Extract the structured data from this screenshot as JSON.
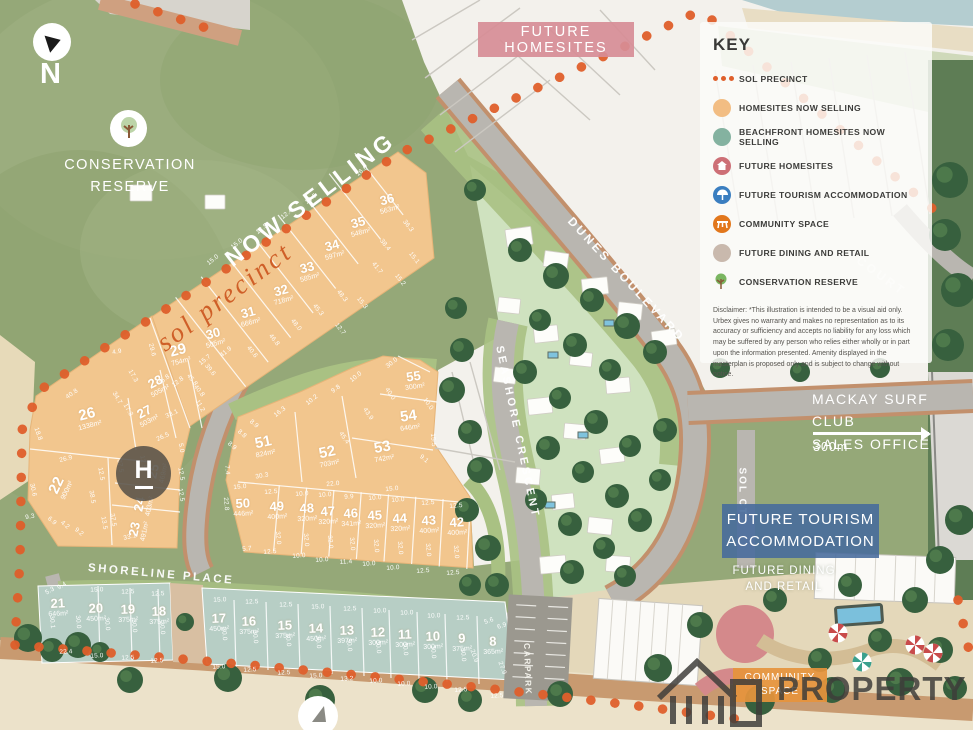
{
  "labels": {
    "north": "N",
    "conservation_line1": "CONSERVATION",
    "conservation_line2": "RESERVE",
    "future_homesites": "FUTURE HOMESITES",
    "now_selling": "NOW SELLING",
    "sol_precinct_script": "sol precinct",
    "helipad": "H",
    "surf_line1": "MACKAY SURF CLUB",
    "surf_line2": "SALES OFFICE",
    "surf_distance": "300m",
    "tourism_line1": "FUTURE TOURISM",
    "tourism_line2": "ACCOMMODATION",
    "dining_line1": "FUTURE DINING",
    "dining_line2": "AND RETAIL",
    "community_line1": "COMMUNITY",
    "community_line2": "SPACE",
    "watermark": "PROPERTY"
  },
  "streets": {
    "dunes": "DUNES BOULEVARD",
    "seashore": "SEASHORE CRESCENT",
    "shoreline": "SHORELINE PLACE",
    "sol": "SOL CT",
    "court": "COURT",
    "carpark": "CARPARK"
  },
  "key": {
    "title": "KEY",
    "items": [
      {
        "label": "SOL PRECINCT",
        "icon": "dots",
        "color": "#df5f2b"
      },
      {
        "label": "HOMESITES NOW SELLING",
        "icon": "circle",
        "color": "#f2bd83"
      },
      {
        "label": "BEACHFRONT HOMESITES NOW SELLING",
        "icon": "circle",
        "color": "#84b2a0"
      },
      {
        "label": "FUTURE HOMESITES",
        "icon": "house",
        "color": "#cd6f76"
      },
      {
        "label": "FUTURE TOURISM ACCOMMODATION",
        "icon": "tourism",
        "color": "#3a7ec0"
      },
      {
        "label": "COMMUNITY SPACE",
        "icon": "community",
        "color": "#e2771c"
      },
      {
        "label": "FUTURE DINING AND RETAIL",
        "icon": "circle",
        "color": "#c9b9ad"
      },
      {
        "label": "CONSERVATION RESERVE",
        "icon": "tree",
        "color": "#7ab661"
      }
    ],
    "disclaimer": "Disclaimer: *This illustration is intended to be a visual aid only. Urbex gives no warranty and makes no representation as to its accuracy or sufficiency and accepts no liability for any loss which may be suffered by any person who relies either wholly or in part upon the information presented. Amenity displayed in the masterplan is proposed only and is subject to change without notice."
  },
  "lots": [
    {
      "n": "29",
      "a": "754m²",
      "x": 179,
      "y": 354,
      "r": -15,
      "t": "o",
      "big": true
    },
    {
      "n": "30",
      "a": "505m²",
      "x": 214,
      "y": 337,
      "r": -15,
      "t": "o"
    },
    {
      "n": "31",
      "a": "666m²",
      "x": 249,
      "y": 316,
      "r": -15,
      "t": "o"
    },
    {
      "n": "32",
      "a": "718m²",
      "x": 282,
      "y": 294,
      "r": -15,
      "t": "o"
    },
    {
      "n": "33",
      "a": "585m²",
      "x": 308,
      "y": 271,
      "r": -15,
      "t": "o"
    },
    {
      "n": "34",
      "a": "597m²",
      "x": 333,
      "y": 249,
      "r": -15,
      "t": "o"
    },
    {
      "n": "35",
      "a": "548m²",
      "x": 359,
      "y": 226,
      "r": -15,
      "t": "o"
    },
    {
      "n": "36",
      "a": "563m²",
      "x": 388,
      "y": 203,
      "r": -15,
      "t": "o"
    },
    {
      "n": "22",
      "a": "900m²",
      "x": 60,
      "y": 487,
      "r": -65,
      "t": "o",
      "big": true
    },
    {
      "n": "26",
      "a": "1338m²",
      "x": 88,
      "y": 418,
      "r": -15,
      "t": "o",
      "big": true
    },
    {
      "n": "27",
      "a": "503m²",
      "x": 146,
      "y": 415,
      "r": -28,
      "t": "o"
    },
    {
      "n": "28",
      "a": "505m²",
      "x": 157,
      "y": 385,
      "r": -28,
      "t": "o"
    },
    {
      "n": "23",
      "a": "491m²",
      "x": 138,
      "y": 530,
      "r": -78,
      "t": "o"
    },
    {
      "n": "24",
      "a": "403m²",
      "x": 143,
      "y": 505,
      "r": -78,
      "t": "o"
    },
    {
      "n": "25",
      "a": "469m²",
      "x": 157,
      "y": 472,
      "r": -78,
      "t": "o"
    },
    {
      "n": "51",
      "a": "824m²",
      "x": 264,
      "y": 446,
      "r": -12,
      "t": "o",
      "big": true
    },
    {
      "n": "52",
      "a": "703m²",
      "x": 328,
      "y": 456,
      "r": -12,
      "t": "o",
      "big": true
    },
    {
      "n": "53",
      "a": "742m²",
      "x": 383,
      "y": 451,
      "r": -10,
      "t": "o",
      "big": true
    },
    {
      "n": "54",
      "a": "646m²",
      "x": 409,
      "y": 420,
      "r": -8,
      "t": "o",
      "big": true
    },
    {
      "n": "55",
      "a": "300m²",
      "x": 414,
      "y": 380,
      "r": -8,
      "t": "o"
    },
    {
      "n": "50",
      "a": "446m²",
      "x": 243,
      "y": 507,
      "r": -3,
      "t": "o"
    },
    {
      "n": "49",
      "a": "400m²",
      "x": 277,
      "y": 510,
      "r": -3,
      "t": "o"
    },
    {
      "n": "48",
      "a": "320m²",
      "x": 307,
      "y": 512,
      "r": -3,
      "t": "o"
    },
    {
      "n": "47",
      "a": "320m²",
      "x": 328,
      "y": 515,
      "r": -3,
      "t": "o"
    },
    {
      "n": "46",
      "a": "341m²",
      "x": 351,
      "y": 517,
      "r": -3,
      "t": "o"
    },
    {
      "n": "45",
      "a": "320m²",
      "x": 375,
      "y": 519,
      "r": -3,
      "t": "o"
    },
    {
      "n": "44",
      "a": "320m²",
      "x": 400,
      "y": 522,
      "r": -3,
      "t": "o"
    },
    {
      "n": "43",
      "a": "400m²",
      "x": 429,
      "y": 524,
      "r": -3,
      "t": "o"
    },
    {
      "n": "42",
      "a": "400m²",
      "x": 457,
      "y": 526,
      "r": -3,
      "t": "o"
    },
    {
      "n": "21",
      "a": "646m²",
      "x": 58,
      "y": 607,
      "r": -3,
      "t": "b"
    },
    {
      "n": "20",
      "a": "450m²",
      "x": 96,
      "y": 612,
      "r": -2,
      "t": "b"
    },
    {
      "n": "19",
      "a": "375m²",
      "x": 128,
      "y": 613,
      "r": -2,
      "t": "b"
    },
    {
      "n": "18",
      "a": "375m²",
      "x": 159,
      "y": 615,
      "r": -2,
      "t": "b"
    },
    {
      "n": "17",
      "a": "450m²",
      "x": 219,
      "y": 622,
      "r": -2,
      "t": "b"
    },
    {
      "n": "16",
      "a": "375m²",
      "x": 249,
      "y": 625,
      "r": -2,
      "t": "b"
    },
    {
      "n": "15",
      "a": "375m²",
      "x": 285,
      "y": 629,
      "r": -2,
      "t": "b"
    },
    {
      "n": "14",
      "a": "450m²",
      "x": 316,
      "y": 632,
      "r": -2,
      "t": "b"
    },
    {
      "n": "13",
      "a": "397m²",
      "x": 347,
      "y": 634,
      "r": -2,
      "t": "b"
    },
    {
      "n": "12",
      "a": "300m²",
      "x": 378,
      "y": 636,
      "r": -2,
      "t": "b"
    },
    {
      "n": "11",
      "a": "300m²",
      "x": 405,
      "y": 638,
      "r": -2,
      "t": "b"
    },
    {
      "n": "10",
      "a": "300m²",
      "x": 433,
      "y": 640,
      "r": -2,
      "t": "b"
    },
    {
      "n": "9",
      "a": "375m²",
      "x": 462,
      "y": 642,
      "r": -2,
      "t": "b"
    },
    {
      "n": "8",
      "a": "365m²",
      "x": 493,
      "y": 645,
      "r": -2,
      "t": "b"
    }
  ],
  "dims": [
    {
      "t": "15.0",
      "x": 213,
      "y": 260,
      "r": -38
    },
    {
      "t": "15.0",
      "x": 237,
      "y": 244,
      "r": -38
    },
    {
      "t": "12.5",
      "x": 262,
      "y": 229,
      "r": -38
    },
    {
      "t": "12.4",
      "x": 287,
      "y": 214,
      "r": -38
    },
    {
      "t": "12.5",
      "x": 311,
      "y": 199,
      "r": -38
    },
    {
      "t": "16.0",
      "x": 362,
      "y": 171,
      "r": -38
    },
    {
      "t": "36.3",
      "x": 408,
      "y": 226,
      "r": 52
    },
    {
      "t": "15.1",
      "x": 414,
      "y": 258,
      "r": 52
    },
    {
      "t": "15.2",
      "x": 400,
      "y": 280,
      "r": 52
    },
    {
      "t": "38.4",
      "x": 385,
      "y": 245,
      "r": 52
    },
    {
      "t": "41.7",
      "x": 377,
      "y": 268,
      "r": 52
    },
    {
      "t": "48.3",
      "x": 342,
      "y": 296,
      "r": 52
    },
    {
      "t": "45.3",
      "x": 318,
      "y": 310,
      "r": 52
    },
    {
      "t": "48.0",
      "x": 296,
      "y": 325,
      "r": 52
    },
    {
      "t": "46.8",
      "x": 274,
      "y": 340,
      "r": 52
    },
    {
      "t": "40.6",
      "x": 252,
      "y": 352,
      "r": 52
    },
    {
      "t": "41.9",
      "x": 226,
      "y": 352,
      "r": -38
    },
    {
      "t": "15.7",
      "x": 205,
      "y": 360,
      "r": -38
    },
    {
      "t": "12.8",
      "x": 178,
      "y": 382,
      "r": -38
    },
    {
      "t": "39.6",
      "x": 210,
      "y": 370,
      "r": 52
    },
    {
      "t": "45.8",
      "x": 192,
      "y": 380,
      "r": 52
    },
    {
      "t": "40.8",
      "x": 199,
      "y": 391,
      "r": 52
    },
    {
      "t": "29.6",
      "x": 152,
      "y": 350,
      "r": 75
    },
    {
      "t": "4.9",
      "x": 117,
      "y": 352,
      "r": -10
    },
    {
      "t": "40.8",
      "x": 72,
      "y": 394,
      "r": -35
    },
    {
      "t": "18.8",
      "x": 38,
      "y": 434,
      "r": 70
    },
    {
      "t": "26.9",
      "x": 66,
      "y": 459,
      "r": -15
    },
    {
      "t": "30.6",
      "x": 33,
      "y": 490,
      "r": 78
    },
    {
      "t": "38.5",
      "x": 92,
      "y": 497,
      "r": 80
    },
    {
      "t": "12.5",
      "x": 101,
      "y": 474,
      "r": 80
    },
    {
      "t": "9.3",
      "x": 30,
      "y": 517,
      "r": -10
    },
    {
      "t": "6.9",
      "x": 52,
      "y": 521,
      "r": 40
    },
    {
      "t": "4.2",
      "x": 65,
      "y": 525,
      "r": 40
    },
    {
      "t": "9.2",
      "x": 79,
      "y": 532,
      "r": 40
    },
    {
      "t": "34.7",
      "x": 117,
      "y": 398,
      "r": 60
    },
    {
      "t": "17.3",
      "x": 128,
      "y": 410,
      "r": 60
    },
    {
      "t": "17.3",
      "x": 133,
      "y": 376,
      "r": 60
    },
    {
      "t": "45.8",
      "x": 164,
      "y": 380,
      "r": -38
    },
    {
      "t": "11.2",
      "x": 200,
      "y": 406,
      "r": 60
    },
    {
      "t": "33.1",
      "x": 172,
      "y": 414,
      "r": -25
    },
    {
      "t": "26.5",
      "x": 163,
      "y": 437,
      "r": -25
    },
    {
      "t": "5.0",
      "x": 181,
      "y": 448,
      "r": 80
    },
    {
      "t": "12.5",
      "x": 181,
      "y": 474,
      "r": 80
    },
    {
      "t": "12.5",
      "x": 181,
      "y": 495,
      "r": 80
    },
    {
      "t": "37.5",
      "x": 120,
      "y": 466,
      "r": 80
    },
    {
      "t": "37.5",
      "x": 113,
      "y": 520,
      "r": 80
    },
    {
      "t": "13.5",
      "x": 104,
      "y": 523,
      "r": 80
    },
    {
      "t": "33.1",
      "x": 130,
      "y": 537,
      "r": -12
    },
    {
      "t": "12.5",
      "x": 143,
      "y": 462,
      "r": 80
    },
    {
      "t": "8.9",
      "x": 254,
      "y": 424,
      "r": 40
    },
    {
      "t": "8.8",
      "x": 242,
      "y": 434,
      "r": 40
    },
    {
      "t": "8.9",
      "x": 232,
      "y": 446,
      "r": 40
    },
    {
      "t": "7.4",
      "x": 227,
      "y": 470,
      "r": 85
    },
    {
      "t": "16.3",
      "x": 280,
      "y": 412,
      "r": -38
    },
    {
      "t": "10.2",
      "x": 312,
      "y": 400,
      "r": -38
    },
    {
      "t": "9.8",
      "x": 336,
      "y": 389,
      "r": -38
    },
    {
      "t": "10.0",
      "x": 356,
      "y": 377,
      "r": -38
    },
    {
      "t": "30.0",
      "x": 392,
      "y": 363,
      "r": -38
    },
    {
      "t": "40.0",
      "x": 390,
      "y": 394,
      "r": 55
    },
    {
      "t": "43.9",
      "x": 368,
      "y": 414,
      "r": 55
    },
    {
      "t": "45.4",
      "x": 344,
      "y": 438,
      "r": 55
    },
    {
      "t": "10.0",
      "x": 428,
      "y": 404,
      "r": 55
    },
    {
      "t": "15.5",
      "x": 433,
      "y": 440,
      "r": 85
    },
    {
      "t": "9.1",
      "x": 424,
      "y": 459,
      "r": 40
    },
    {
      "t": "15.3",
      "x": 362,
      "y": 303,
      "r": 52
    },
    {
      "t": "12.7",
      "x": 340,
      "y": 329,
      "r": 52
    },
    {
      "t": "30.3",
      "x": 262,
      "y": 476,
      "r": -10
    },
    {
      "t": "22.0",
      "x": 333,
      "y": 484,
      "r": -5
    },
    {
      "t": "15.0",
      "x": 240,
      "y": 487,
      "r": -5
    },
    {
      "t": "15.0",
      "x": 392,
      "y": 489,
      "r": -5
    },
    {
      "t": "12.5",
      "x": 271,
      "y": 492,
      "r": -4
    },
    {
      "t": "10.0",
      "x": 302,
      "y": 494,
      "r": -4
    },
    {
      "t": "10.0",
      "x": 325,
      "y": 495,
      "r": -4
    },
    {
      "t": "9.9",
      "x": 349,
      "y": 497,
      "r": -4
    },
    {
      "t": "10.0",
      "x": 375,
      "y": 498,
      "r": -4
    },
    {
      "t": "10.0",
      "x": 398,
      "y": 500,
      "r": -4
    },
    {
      "t": "12.5",
      "x": 428,
      "y": 503,
      "r": -4
    },
    {
      "t": "12.5",
      "x": 456,
      "y": 506,
      "r": -4
    },
    {
      "t": "5.7",
      "x": 247,
      "y": 549,
      "r": -4
    },
    {
      "t": "12.5",
      "x": 270,
      "y": 552,
      "r": -4
    },
    {
      "t": "10.0",
      "x": 299,
      "y": 556,
      "r": -4
    },
    {
      "t": "10.0",
      "x": 322,
      "y": 560,
      "r": -4
    },
    {
      "t": "11.4",
      "x": 346,
      "y": 562,
      "r": -4
    },
    {
      "t": "10.0",
      "x": 369,
      "y": 564,
      "r": -4
    },
    {
      "t": "10.0",
      "x": 393,
      "y": 568,
      "r": -4
    },
    {
      "t": "12.5",
      "x": 423,
      "y": 571,
      "r": -4
    },
    {
      "t": "12.5",
      "x": 453,
      "y": 573,
      "r": -4
    },
    {
      "t": "22.8",
      "x": 226,
      "y": 504,
      "r": 85
    },
    {
      "t": "32.0",
      "x": 278,
      "y": 538,
      "r": 85
    },
    {
      "t": "32.0",
      "x": 306,
      "y": 540,
      "r": 85
    },
    {
      "t": "32.0",
      "x": 330,
      "y": 542,
      "r": 85
    },
    {
      "t": "32.0",
      "x": 352,
      "y": 544,
      "r": 85
    },
    {
      "t": "32.0",
      "x": 376,
      "y": 546,
      "r": 85
    },
    {
      "t": "32.0",
      "x": 400,
      "y": 548,
      "r": 85
    },
    {
      "t": "32.0",
      "x": 428,
      "y": 550,
      "r": 85
    },
    {
      "t": "32.0",
      "x": 456,
      "y": 552,
      "r": 85
    },
    {
      "t": "9.4",
      "x": 62,
      "y": 586,
      "r": -30
    },
    {
      "t": "5.3",
      "x": 50,
      "y": 591,
      "r": -30
    },
    {
      "t": "15.0",
      "x": 97,
      "y": 590,
      "r": -2
    },
    {
      "t": "12.5",
      "x": 128,
      "y": 592,
      "r": -2
    },
    {
      "t": "12.5",
      "x": 158,
      "y": 594,
      "r": -2
    },
    {
      "t": "15.0",
      "x": 220,
      "y": 600,
      "r": -2
    },
    {
      "t": "12.5",
      "x": 252,
      "y": 602,
      "r": -2
    },
    {
      "t": "12.5",
      "x": 286,
      "y": 605,
      "r": -2
    },
    {
      "t": "15.0",
      "x": 318,
      "y": 607,
      "r": -2
    },
    {
      "t": "12.5",
      "x": 350,
      "y": 609,
      "r": -2
    },
    {
      "t": "10.0",
      "x": 380,
      "y": 611,
      "r": -2
    },
    {
      "t": "10.0",
      "x": 407,
      "y": 613,
      "r": -2
    },
    {
      "t": "10.0",
      "x": 434,
      "y": 616,
      "r": -2
    },
    {
      "t": "12.5",
      "x": 463,
      "y": 618,
      "r": -2
    },
    {
      "t": "5.6",
      "x": 489,
      "y": 621,
      "r": -20
    },
    {
      "t": "6.9",
      "x": 502,
      "y": 626,
      "r": -20
    },
    {
      "t": "22.4",
      "x": 66,
      "y": 652,
      "r": -3
    },
    {
      "t": "15.0",
      "x": 97,
      "y": 656,
      "r": -3
    },
    {
      "t": "12.5",
      "x": 128,
      "y": 658,
      "r": -3
    },
    {
      "t": "12.5",
      "x": 157,
      "y": 661,
      "r": -3
    },
    {
      "t": "15.0",
      "x": 219,
      "y": 667,
      "r": -3
    },
    {
      "t": "12.5",
      "x": 250,
      "y": 670,
      "r": -3
    },
    {
      "t": "12.5",
      "x": 284,
      "y": 673,
      "r": -3
    },
    {
      "t": "15.0",
      "x": 316,
      "y": 676,
      "r": -3
    },
    {
      "t": "13.2",
      "x": 347,
      "y": 679,
      "r": -3
    },
    {
      "t": "10.0",
      "x": 376,
      "y": 681,
      "r": -3
    },
    {
      "t": "10.0",
      "x": 404,
      "y": 684,
      "r": -3
    },
    {
      "t": "10.0",
      "x": 431,
      "y": 687,
      "r": -3
    },
    {
      "t": "12.5",
      "x": 461,
      "y": 690,
      "r": -3
    },
    {
      "t": "12.5",
      "x": 497,
      "y": 696,
      "r": -3
    },
    {
      "t": "27.9",
      "x": 502,
      "y": 668,
      "r": 70
    },
    {
      "t": "20.9",
      "x": 474,
      "y": 656,
      "r": 70
    },
    {
      "t": "30.1",
      "x": 52,
      "y": 622,
      "r": 85
    },
    {
      "t": "30.0",
      "x": 78,
      "y": 622,
      "r": 85
    },
    {
      "t": "30.0",
      "x": 107,
      "y": 624,
      "r": 85
    },
    {
      "t": "30.0",
      "x": 134,
      "y": 626,
      "r": 85
    },
    {
      "t": "30.0",
      "x": 162,
      "y": 628,
      "r": 85
    },
    {
      "t": "30.0",
      "x": 224,
      "y": 634,
      "r": 85
    },
    {
      "t": "30.0",
      "x": 255,
      "y": 637,
      "r": 85
    },
    {
      "t": "30.0",
      "x": 288,
      "y": 640,
      "r": 85
    },
    {
      "t": "30.0",
      "x": 318,
      "y": 642,
      "r": 85
    },
    {
      "t": "30.0",
      "x": 349,
      "y": 645,
      "r": 85
    },
    {
      "t": "30.0",
      "x": 378,
      "y": 647,
      "r": 85
    },
    {
      "t": "30.0",
      "x": 405,
      "y": 649,
      "r": 85
    },
    {
      "t": "30.0",
      "x": 433,
      "y": 652,
      "r": 85
    },
    {
      "t": "30.0",
      "x": 463,
      "y": 655,
      "r": 85
    }
  ]
}
